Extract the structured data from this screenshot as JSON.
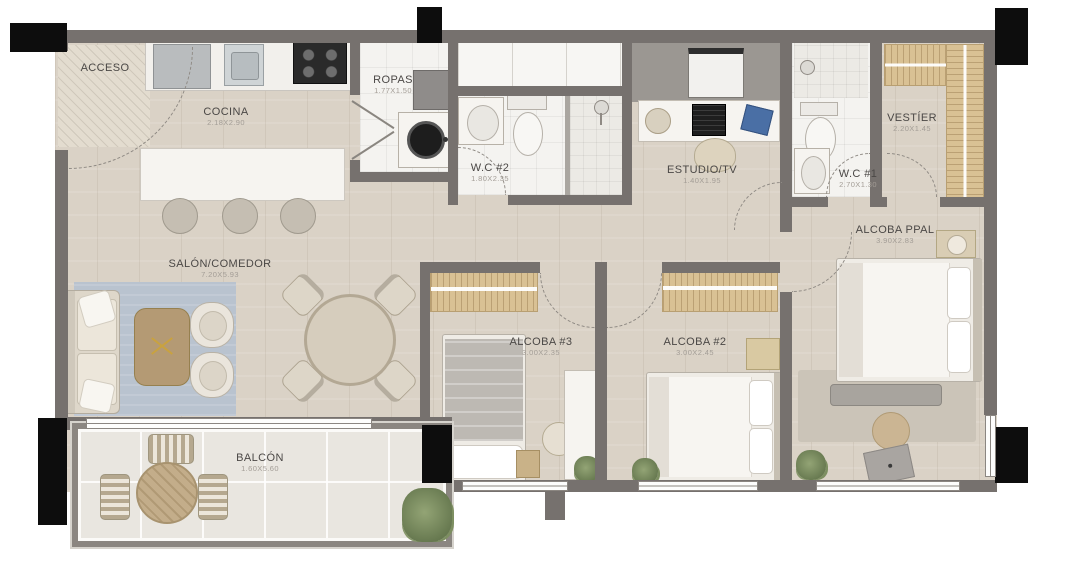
{
  "plan": {
    "type": "apartment-floor-plan",
    "colors": {
      "wall": "#76716e",
      "column": "#0d0d0d",
      "wood_floor": "#dad2c6",
      "tile_floor": "#f4f3f0",
      "balcony_floor": "#e9e6e0",
      "rug": "#b9c3cf",
      "closet_wood": "#d9c194",
      "accent_blue": "#4a6fa5",
      "label_text": "#4b4846",
      "dim_text": "#a39d96"
    },
    "rooms": [
      {
        "id": "acceso",
        "label": "ACCESO",
        "dims": ""
      },
      {
        "id": "cocina",
        "label": "COCINA",
        "dims": "2.18X2.90"
      },
      {
        "id": "ropas",
        "label": "ROPAS",
        "dims": "1.77X1.50"
      },
      {
        "id": "wc2",
        "label": "W.C #2",
        "dims": "1.80X2.35"
      },
      {
        "id": "estudio",
        "label": "ESTUDIO/TV",
        "dims": "1.40X1.95"
      },
      {
        "id": "wc1",
        "label": "W.C #1",
        "dims": "2.70X1.30"
      },
      {
        "id": "vestier",
        "label": "VESTÍER",
        "dims": "2.20X1.45"
      },
      {
        "id": "alcoba_ppal",
        "label": "ALCOBA PPAL",
        "dims": "3.90X2.83"
      },
      {
        "id": "salon",
        "label": "SALÓN/COMEDOR",
        "dims": "7.20X5.93"
      },
      {
        "id": "alcoba3",
        "label": "ALCOBA #3",
        "dims": "3.00X2.35"
      },
      {
        "id": "alcoba2",
        "label": "ALCOBA #2",
        "dims": "3.00X2.45"
      },
      {
        "id": "balcon",
        "label": "BALCÓN",
        "dims": "1.60X5.60"
      }
    ]
  }
}
